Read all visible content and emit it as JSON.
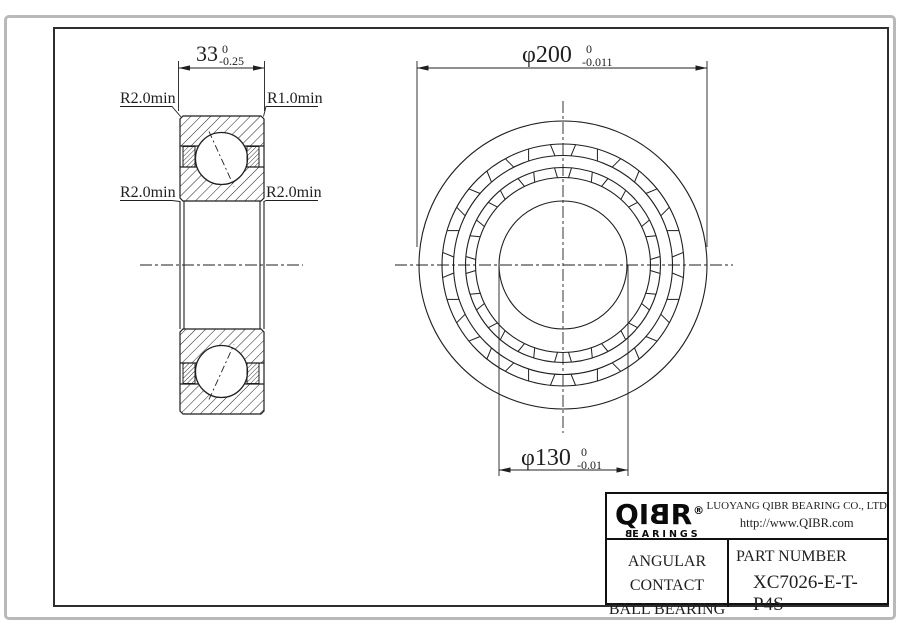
{
  "section_view": {
    "width_dim": {
      "value": "33",
      "tol_upper": "0",
      "tol_lower": "-0.25"
    },
    "labels": {
      "top_left": "R2.0min",
      "top_right": "R1.0min",
      "mid_left": "R2.0min",
      "mid_right": "R2.0min"
    }
  },
  "front_view": {
    "outer_dim": {
      "symbol": "φ",
      "value": "200",
      "tol_upper": "0",
      "tol_lower": "-0.011"
    },
    "bore_dim": {
      "symbol": "φ",
      "value": "130",
      "tol_upper": "0",
      "tol_lower": "-0.01"
    }
  },
  "title_block": {
    "logo": {
      "brand_left": "QI",
      "brand_mirrored": "B",
      "brand_right": "R",
      "registered": "®",
      "sub_mirrored": "B",
      "sub_rest": "EARINGS"
    },
    "company": "LUOYANG QIBR BEARING CO., LTD",
    "website": "http://www.QIBR.com",
    "product": {
      "line1": "ANGULAR CONTACT",
      "line2": "BALL BEARING"
    },
    "part": {
      "label": "PART NUMBER",
      "number": "XC7026-E-T-P4S"
    }
  },
  "colors": {
    "line": "#1f1f1f",
    "frame": "#2e2e2e",
    "outer_border": "#b9b9b9"
  }
}
